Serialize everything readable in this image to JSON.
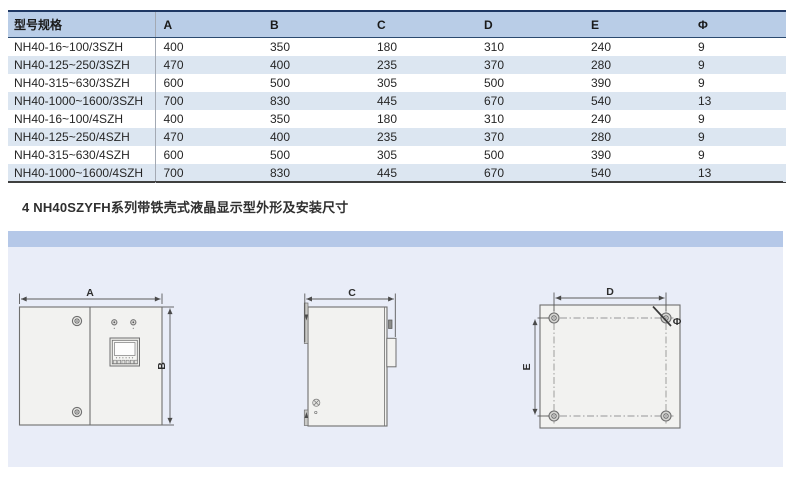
{
  "table": {
    "headers": {
      "model": "型号规格",
      "a": "A",
      "b": "B",
      "c": "C",
      "d": "D",
      "e": "E",
      "phi": "Φ"
    },
    "rows": [
      {
        "model": "NH40-16~100/3SZH",
        "a": "400",
        "b": "350",
        "c": "180",
        "d": "310",
        "e": "240",
        "phi": "9"
      },
      {
        "model": "NH40-125~250/3SZH",
        "a": "470",
        "b": "400",
        "c": "235",
        "d": "370",
        "e": "280",
        "phi": "9"
      },
      {
        "model": "NH40-315~630/3SZH",
        "a": "600",
        "b": "500",
        "c": "305",
        "d": "500",
        "e": "390",
        "phi": "9"
      },
      {
        "model": "NH40-1000~1600/3SZH",
        "a": "700",
        "b": "830",
        "c": "445",
        "d": "670",
        "e": "540",
        "phi": "13"
      },
      {
        "model": "NH40-16~100/4SZH",
        "a": "400",
        "b": "350",
        "c": "180",
        "d": "310",
        "e": "240",
        "phi": "9"
      },
      {
        "model": "NH40-125~250/4SZH",
        "a": "470",
        "b": "400",
        "c": "235",
        "d": "370",
        "e": "280",
        "phi": "9"
      },
      {
        "model": "NH40-315~630/4SZH",
        "a": "600",
        "b": "500",
        "c": "305",
        "d": "500",
        "e": "390",
        "phi": "9"
      },
      {
        "model": "NH40-1000~1600/4SZH",
        "a": "700",
        "b": "830",
        "c": "445",
        "d": "670",
        "e": "540",
        "phi": "13"
      }
    ]
  },
  "section_heading": "4 NH40SZYFH系列带铁壳式液晶显示型外形及安装尺寸",
  "diagram": {
    "front_view": {
      "width_label": "A",
      "height_label": "B"
    },
    "side_view": {
      "depth_label": "C"
    },
    "back_view": {
      "hole_spacing_h_label": "D",
      "hole_spacing_v_label": "E",
      "hole_dia_label": "Φ"
    }
  },
  "colors": {
    "table_header_bg": "#b9cde7",
    "table_top_border": "#1f3864",
    "row_alt_bg": "#dce6f1",
    "panel_strip": "#b5c8e8",
    "panel_bg": "#e9edf8",
    "drawing_line": "#6f6f6f"
  }
}
